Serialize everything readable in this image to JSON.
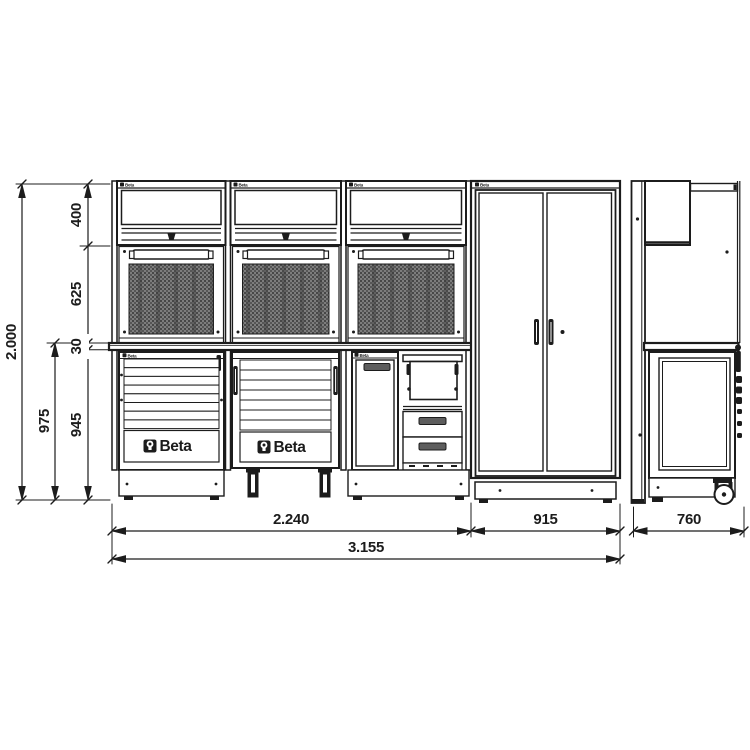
{
  "brand": "Beta",
  "dimensions": {
    "total_height": "2.000",
    "worktop_height": "975",
    "wall_unit_height": "400",
    "panel_height": "625",
    "worktop_thickness": "30",
    "base_cabinet_height": "945",
    "bench_width": "2.240",
    "tall_cabinet_width": "915",
    "total_width": "3.155",
    "depth": "760"
  },
  "colors": {
    "line": "#1c1c1c",
    "panel_fill": "#787878",
    "panel_dot": "#454545",
    "background": "#ffffff"
  }
}
